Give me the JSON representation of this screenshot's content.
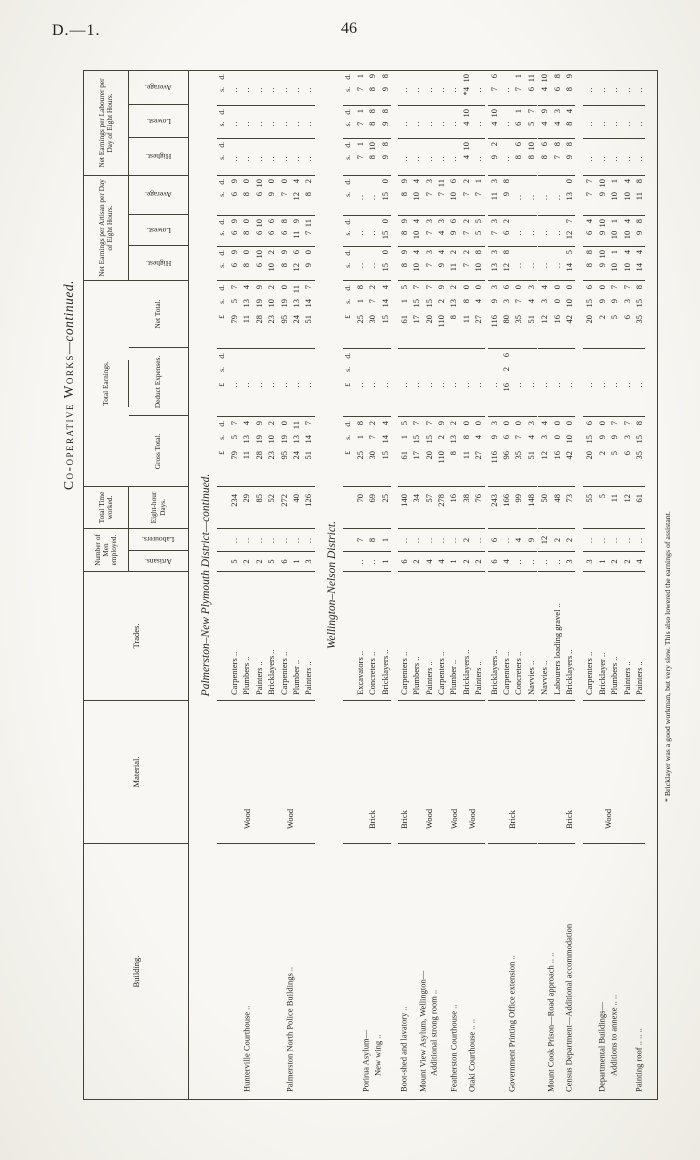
{
  "page": {
    "corner_label": "D.—1.",
    "page_number": "46"
  },
  "title": {
    "smallcaps": "Co-operative Works",
    "suffix": "—continued."
  },
  "header": {
    "building": "Building.",
    "material": "Material.",
    "trades": "Trades.",
    "number_group": "Number of Men employed.",
    "artisans": "Artisans.",
    "labourers": "Labourers.",
    "time_group": "Total Time worked.",
    "days_sub": "Eight-hour Days.",
    "earnings_group": "Total Earnings.",
    "gross": "Gross Total.",
    "deduct": "Deduct Expenses.",
    "net": "Net Total.",
    "artisan_group": "Net Earnings per Artisan per Day of Eight Hours.",
    "labourer_group": "Net Earnings per Labourer per Day of Eight Hours.",
    "highest": "Highest.",
    "lowest": "Lowest.",
    "average": "Average."
  },
  "sd_header": {
    "pound": "£",
    "s": "s.",
    "d": "d."
  },
  "footnote": "* Bricklayer was a good workman, but very slow.  This also lowered the earnings of assistant.",
  "sections": [
    {
      "heading": "Palmerston–New Plymouth District—continued.",
      "groups": [
        {
          "building": [
            "Hunterville Courthouse  .."
          ],
          "material": "Wood",
          "margin": 0,
          "rows": [
            {
              "trade": "Carpenters ..",
              "art": "5",
              "lab": null,
              "days": "234",
              "gross": [
                "79",
                "5",
                "7"
              ],
              "deduct": null,
              "net": [
                "79",
                "5",
                "7"
              ],
              "a_h": "6 9",
              "a_l": "6 9",
              "a_a": "6 9",
              "l_h": null,
              "l_l": null,
              "l_a": null
            },
            {
              "trade": "Plumbers ..",
              "art": "2",
              "lab": null,
              "days": "29",
              "gross": [
                "11",
                "13",
                "4"
              ],
              "deduct": null,
              "net": [
                "11",
                "13",
                "4"
              ],
              "a_h": "8 0",
              "a_l": "8 0",
              "a_a": "8 0",
              "l_h": null,
              "l_l": null,
              "l_a": null
            },
            {
              "trade": "Painters ..",
              "art": "2",
              "lab": null,
              "days": "85",
              "gross": [
                "28",
                "19",
                "9"
              ],
              "deduct": null,
              "net": [
                "28",
                "19",
                "9"
              ],
              "a_h": "6 10",
              "a_l": "6 10",
              "a_a": "6 10",
              "l_h": null,
              "l_l": null,
              "l_a": null
            }
          ]
        },
        {
          "building": [
            "Palmerston North Police Buildings  .."
          ],
          "material": "Wood",
          "margin": 0,
          "rows": [
            {
              "trade": "Bricklayers ..",
              "art": "5",
              "lab": null,
              "days": "52",
              "gross": [
                "23",
                "10",
                "2"
              ],
              "deduct": null,
              "net": [
                "23",
                "10",
                "2"
              ],
              "a_h": "10 2",
              "a_l": "6 6",
              "a_a": "9 0",
              "l_h": null,
              "l_l": null,
              "l_a": null
            },
            {
              "trade": "Carpenters ..",
              "art": "6",
              "lab": null,
              "days": "272",
              "gross": [
                "95",
                "19",
                "0"
              ],
              "deduct": null,
              "net": [
                "95",
                "19",
                "0"
              ],
              "a_h": "8 9",
              "a_l": "6 8",
              "a_a": "7 0",
              "l_h": null,
              "l_l": null,
              "l_a": null
            },
            {
              "trade": "Plumber ..",
              "art": "1",
              "lab": null,
              "days": "40",
              "gross": [
                "24",
                "13",
                "11"
              ],
              "deduct": null,
              "net": [
                "24",
                "13",
                "11"
              ],
              "a_h": "12 6",
              "a_l": "11 9",
              "a_a": "12 4",
              "l_h": null,
              "l_l": null,
              "l_a": null
            },
            {
              "trade": "Painters ..",
              "art": "3",
              "lab": null,
              "days": "126",
              "gross": [
                "51",
                "14",
                "7"
              ],
              "deduct": null,
              "net": [
                "51",
                "14",
                "7"
              ],
              "a_h": "9 0",
              "a_l": "7 11",
              "a_a": "8 2",
              "l_h": null,
              "l_l": null,
              "l_a": null
            }
          ]
        }
      ]
    },
    {
      "heading": "Wellington–Nelson District.",
      "groups": [
        {
          "building": [
            "Porirua Asylum—",
            "New wing  .."
          ],
          "material": "Brick",
          "margin": 0,
          "rows": [
            {
              "trade": "Excavators ..",
              "art": null,
              "lab": "7",
              "days": "70",
              "gross": [
                "25",
                "1",
                "8"
              ],
              "deduct": null,
              "net": [
                "25",
                "1",
                "8"
              ],
              "a_h": null,
              "a_l": null,
              "a_a": null,
              "l_h": "7 1",
              "l_l": "7 1",
              "l_a": "7 1"
            },
            {
              "trade": "Concreters ..",
              "art": null,
              "lab": "8",
              "days": "69",
              "gross": [
                "30",
                "7",
                "2"
              ],
              "deduct": null,
              "net": [
                "30",
                "7",
                "2"
              ],
              "a_h": null,
              "a_l": null,
              "a_a": null,
              "l_h": "8 10",
              "l_l": "8 8",
              "l_a": "8 9"
            },
            {
              "trade": "Bricklayers ..",
              "art": "1",
              "lab": "1",
              "days": "25",
              "gross": [
                "15",
                "14",
                "4"
              ],
              "deduct": null,
              "net": [
                "15",
                "14",
                "4"
              ],
              "a_h": "15 0",
              "a_l": "15 0",
              "a_a": "15 0",
              "l_h": "9 8",
              "l_l": "9 8",
              "l_a": "9 8"
            }
          ]
        },
        {
          "building": [
            "Boot-shed and lavatory  .."
          ],
          "material": "Brick",
          "margin": 7,
          "rows": [
            {
              "trade": "Carpenters ..",
              "art": "6",
              "lab": null,
              "days": "140",
              "gross": [
                "61",
                "1",
                "5"
              ],
              "deduct": null,
              "net": [
                "61",
                "1",
                "5"
              ],
              "a_h": "8 9",
              "a_l": "8 9",
              "a_a": "8 9",
              "l_h": null,
              "l_l": null,
              "l_a": null
            }
          ]
        },
        {
          "building": [
            "Mount View Asylum, Wellington—",
            "Additional strong room  .."
          ],
          "material": "Wood",
          "margin": 0,
          "rows": [
            {
              "trade": "Plumbers ..",
              "art": "2",
              "lab": null,
              "days": "34",
              "gross": [
                "17",
                "15",
                "7"
              ],
              "deduct": null,
              "net": [
                "17",
                "15",
                "7"
              ],
              "a_h": "10 4",
              "a_l": "10 4",
              "a_a": "10 4",
              "l_h": null,
              "l_l": null,
              "l_a": null
            },
            {
              "trade": "Painters ..",
              "art": "4",
              "lab": null,
              "days": "57",
              "gross": [
                "20",
                "15",
                "7"
              ],
              "deduct": null,
              "net": [
                "20",
                "15",
                "7"
              ],
              "a_h": "7 3",
              "a_l": "7 3",
              "a_a": "7 3",
              "l_h": null,
              "l_l": null,
              "l_a": null
            },
            {
              "trade": "Carpenters ..",
              "art": "4",
              "lab": null,
              "days": "278",
              "gross": [
                "110",
                "2",
                "9"
              ],
              "deduct": null,
              "net": [
                "110",
                "2",
                "9"
              ],
              "a_h": "9 4",
              "a_l": "4 3",
              "a_a": "7 11",
              "l_h": null,
              "l_l": null,
              "l_a": null
            }
          ]
        },
        {
          "building": [
            "Featherston Courthouse  .."
          ],
          "material": "Wood",
          "margin": 0,
          "rows": [
            {
              "trade": "Plumber ..",
              "art": "1",
              "lab": null,
              "days": "16",
              "gross": [
                "8",
                "13",
                "2"
              ],
              "deduct": null,
              "net": [
                "8",
                "13",
                "2"
              ],
              "a_h": "11 2",
              "a_l": "9 6",
              "a_a": "10 6",
              "l_h": null,
              "l_l": null,
              "l_a": null
            }
          ]
        },
        {
          "building": [
            "Otaki Courthouse  ..  .."
          ],
          "material": "Wood",
          "margin": 0,
          "rows": [
            {
              "trade": "Bricklayers ..",
              "art": "2",
              "lab": "2",
              "days": "38",
              "gross": [
                "11",
                "8",
                "0"
              ],
              "deduct": null,
              "net": [
                "11",
                "8",
                "0"
              ],
              "a_h": "7 2",
              "a_l": "7 2",
              "a_a": "7 2",
              "l_h": "4 10",
              "l_l": "4 10",
              "l_a": "*4 10"
            },
            {
              "trade": "Painters ..",
              "art": "2",
              "lab": null,
              "days": "76",
              "gross": [
                "27",
                "4",
                "0"
              ],
              "deduct": null,
              "net": [
                "27",
                "4",
                "0"
              ],
              "a_h": "10 8",
              "a_l": "5 5",
              "a_a": "7 1",
              "l_h": null,
              "l_l": null,
              "l_a": null
            }
          ]
        },
        {
          "building": [
            "Government Printing Office extension  .."
          ],
          "material": "Brick",
          "margin": 3,
          "rows": [
            {
              "trade": "Bricklayers ..",
              "art": "6",
              "lab": "6",
              "days": "243",
              "gross": [
                "116",
                "9",
                "3"
              ],
              "deduct": null,
              "net": [
                "116",
                "9",
                "3"
              ],
              "a_h": "13 3",
              "a_l": "7 3",
              "a_a": "11 3",
              "l_h": "9 2",
              "l_l": "4 10",
              "l_a": "7 6"
            },
            {
              "trade": "Carpenters ..",
              "art": "4",
              "lab": null,
              "days": "166",
              "gross": [
                "96",
                "6",
                "0"
              ],
              "deduct": [
                "16",
                "2",
                "6"
              ],
              "net": [
                "80",
                "3",
                "6"
              ],
              "a_h": "12 8",
              "a_l": "6 2",
              "a_a": "9 8",
              "l_h": null,
              "l_l": null,
              "l_a": null
            },
            {
              "trade": "Concreters ..",
              "art": null,
              "lab": "4",
              "days": "99",
              "gross": [
                "35",
                "7",
                "0"
              ],
              "deduct": null,
              "net": [
                "35",
                "7",
                "0"
              ],
              "a_h": null,
              "a_l": null,
              "a_a": null,
              "l_h": "8 6",
              "l_l": "6 1",
              "l_a": "7 1"
            },
            {
              "trade": "Navvies ..",
              "art": null,
              "lab": "9",
              "days": "148",
              "gross": [
                "51",
                "4",
                "3"
              ],
              "deduct": null,
              "net": [
                "51",
                "4",
                "3"
              ],
              "a_h": null,
              "a_l": null,
              "a_a": null,
              "l_h": "8 10",
              "l_l": "5 7",
              "l_a": "6 11"
            }
          ]
        },
        {
          "building": [
            "Mount Cook Prison—Road approach ..  .."
          ],
          "material": null,
          "margin": 1,
          "rows": [
            {
              "trade": "Navvies ..",
              "art": null,
              "lab": "12",
              "days": "50",
              "gross": [
                "12",
                "3",
                "4"
              ],
              "deduct": null,
              "net": [
                "12",
                "3",
                "4"
              ],
              "a_h": null,
              "a_l": null,
              "a_a": null,
              "l_h": "8 6",
              "l_l": "4 9",
              "l_a": "4 10"
            },
            {
              "trade": "Labourers loading gravel ..",
              "art": null,
              "lab": "2",
              "days": "48",
              "gross": [
                "16",
                "0",
                "0"
              ],
              "deduct": null,
              "net": [
                "16",
                "0",
                "0"
              ],
              "a_h": null,
              "a_l": null,
              "a_a": null,
              "l_h": "7 8",
              "l_l": "4 3",
              "l_a": "6 8"
            }
          ]
        },
        {
          "building": [
            "Census Department—Additional accommodation"
          ],
          "material": "Brick",
          "margin": 0,
          "rows": [
            {
              "trade": "Bricklayers ..",
              "art": "3",
              "lab": "2",
              "days": "73",
              "gross": [
                "42",
                "10",
                "0"
              ],
              "deduct": null,
              "net": [
                "42",
                "10",
                "0"
              ],
              "a_h": "14 5",
              "a_l": "12 7",
              "a_a": "13 0",
              "l_h": "9 8",
              "l_l": "8 4",
              "l_a": "8 9"
            }
          ]
        },
        {
          "building": [
            "Departmental Buildings—",
            "Additions to annexe  ..  .."
          ],
          "material": "Wood",
          "margin": 8,
          "rows": [
            {
              "trade": "Carpenters ..",
              "art": "3",
              "lab": null,
              "days": "55",
              "gross": [
                "20",
                "15",
                "6"
              ],
              "deduct": null,
              "net": [
                "20",
                "15",
                "6"
              ],
              "a_h": "8 8",
              "a_l": "6 4",
              "a_a": "7 7",
              "l_h": null,
              "l_l": null,
              "l_a": null
            },
            {
              "trade": "Bricklayer ..",
              "art": "1",
              "lab": null,
              "days": "5",
              "gross": [
                "2",
                "9",
                "0"
              ],
              "deduct": null,
              "net": [
                "2",
                "9",
                "0"
              ],
              "a_h": "9 10",
              "a_l": "9 10",
              "a_a": "9 10",
              "l_h": null,
              "l_l": null,
              "l_a": null
            },
            {
              "trade": "Plumbers ..",
              "art": "2",
              "lab": null,
              "days": "11",
              "gross": [
                "5",
                "9",
                "7"
              ],
              "deduct": null,
              "net": [
                "5",
                "9",
                "7"
              ],
              "a_h": "10 1",
              "a_l": "10 1",
              "a_a": "10 1",
              "l_h": null,
              "l_l": null,
              "l_a": null
            },
            {
              "trade": "Painters ..",
              "art": "2",
              "lab": null,
              "days": "12",
              "gross": [
                "6",
                "3",
                "7"
              ],
              "deduct": null,
              "net": [
                "6",
                "3",
                "7"
              ],
              "a_h": "10 4",
              "a_l": "10 4",
              "a_a": "10 4",
              "l_h": null,
              "l_l": null,
              "l_a": null
            }
          ]
        },
        {
          "building": [
            "Painting roof  ..  ..  .."
          ],
          "material": null,
          "margin": 0,
          "rows": [
            {
              "trade": "Painters ..",
              "art": "4",
              "lab": null,
              "days": "61",
              "gross": [
                "35",
                "15",
                "8"
              ],
              "deduct": null,
              "net": [
                "35",
                "15",
                "8"
              ],
              "a_h": "14 4",
              "a_l": "9 8",
              "a_a": "11 8",
              "l_h": null,
              "l_l": null,
              "l_a": null
            }
          ]
        }
      ]
    }
  ]
}
